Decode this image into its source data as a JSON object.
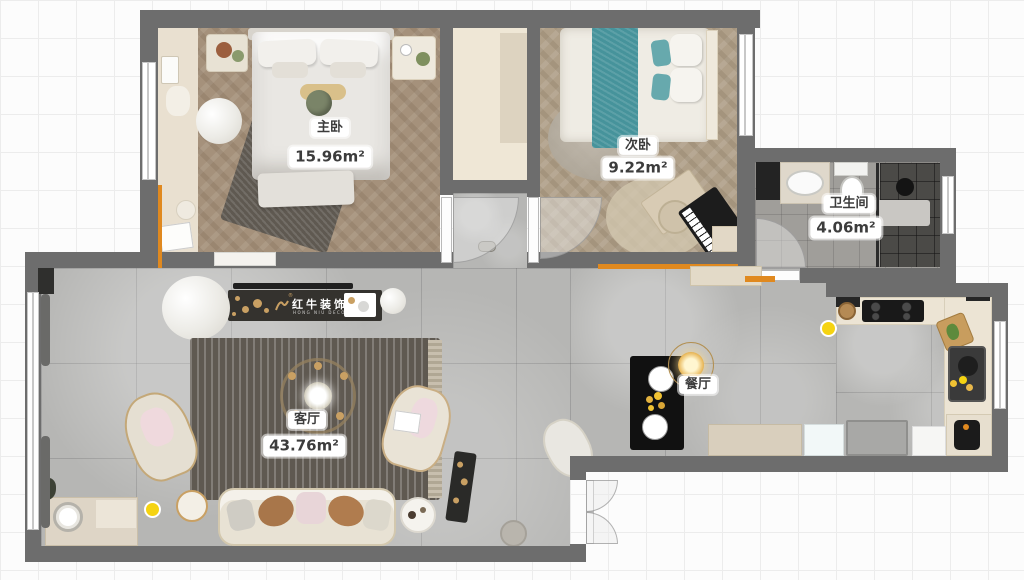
{
  "canvas": {
    "width": 1024,
    "height": 580
  },
  "rooms": {
    "master": {
      "name": "主卧",
      "area": "15.96m²"
    },
    "second": {
      "name": "次卧",
      "area": "9.22m²"
    },
    "bathroom": {
      "name": "卫生间",
      "area": "4.06m²"
    },
    "living": {
      "name": "客厅",
      "area": "43.76m²"
    },
    "dining": {
      "name": "餐厅"
    }
  },
  "logo": {
    "brand": "红牛装饰",
    "registered": "®",
    "subtitle": "HONG NIU DECORATION"
  },
  "colors": {
    "wall": "#6d6d6d",
    "accent_orange": "#e0891f",
    "teal_bedding": "#46939b",
    "gold": "#c9a063",
    "floor_gray": "#b6b6b4",
    "floor_wood_master": "#a5917b",
    "floor_wood_second": "#b0a089",
    "smart_light_dot": "#f5d312",
    "logo_bar": "#34322e"
  },
  "icons": {
    "smart_light": "smart-light-dot",
    "chandelier": "chandelier-icon",
    "pendant": "pendant-light-icon"
  }
}
